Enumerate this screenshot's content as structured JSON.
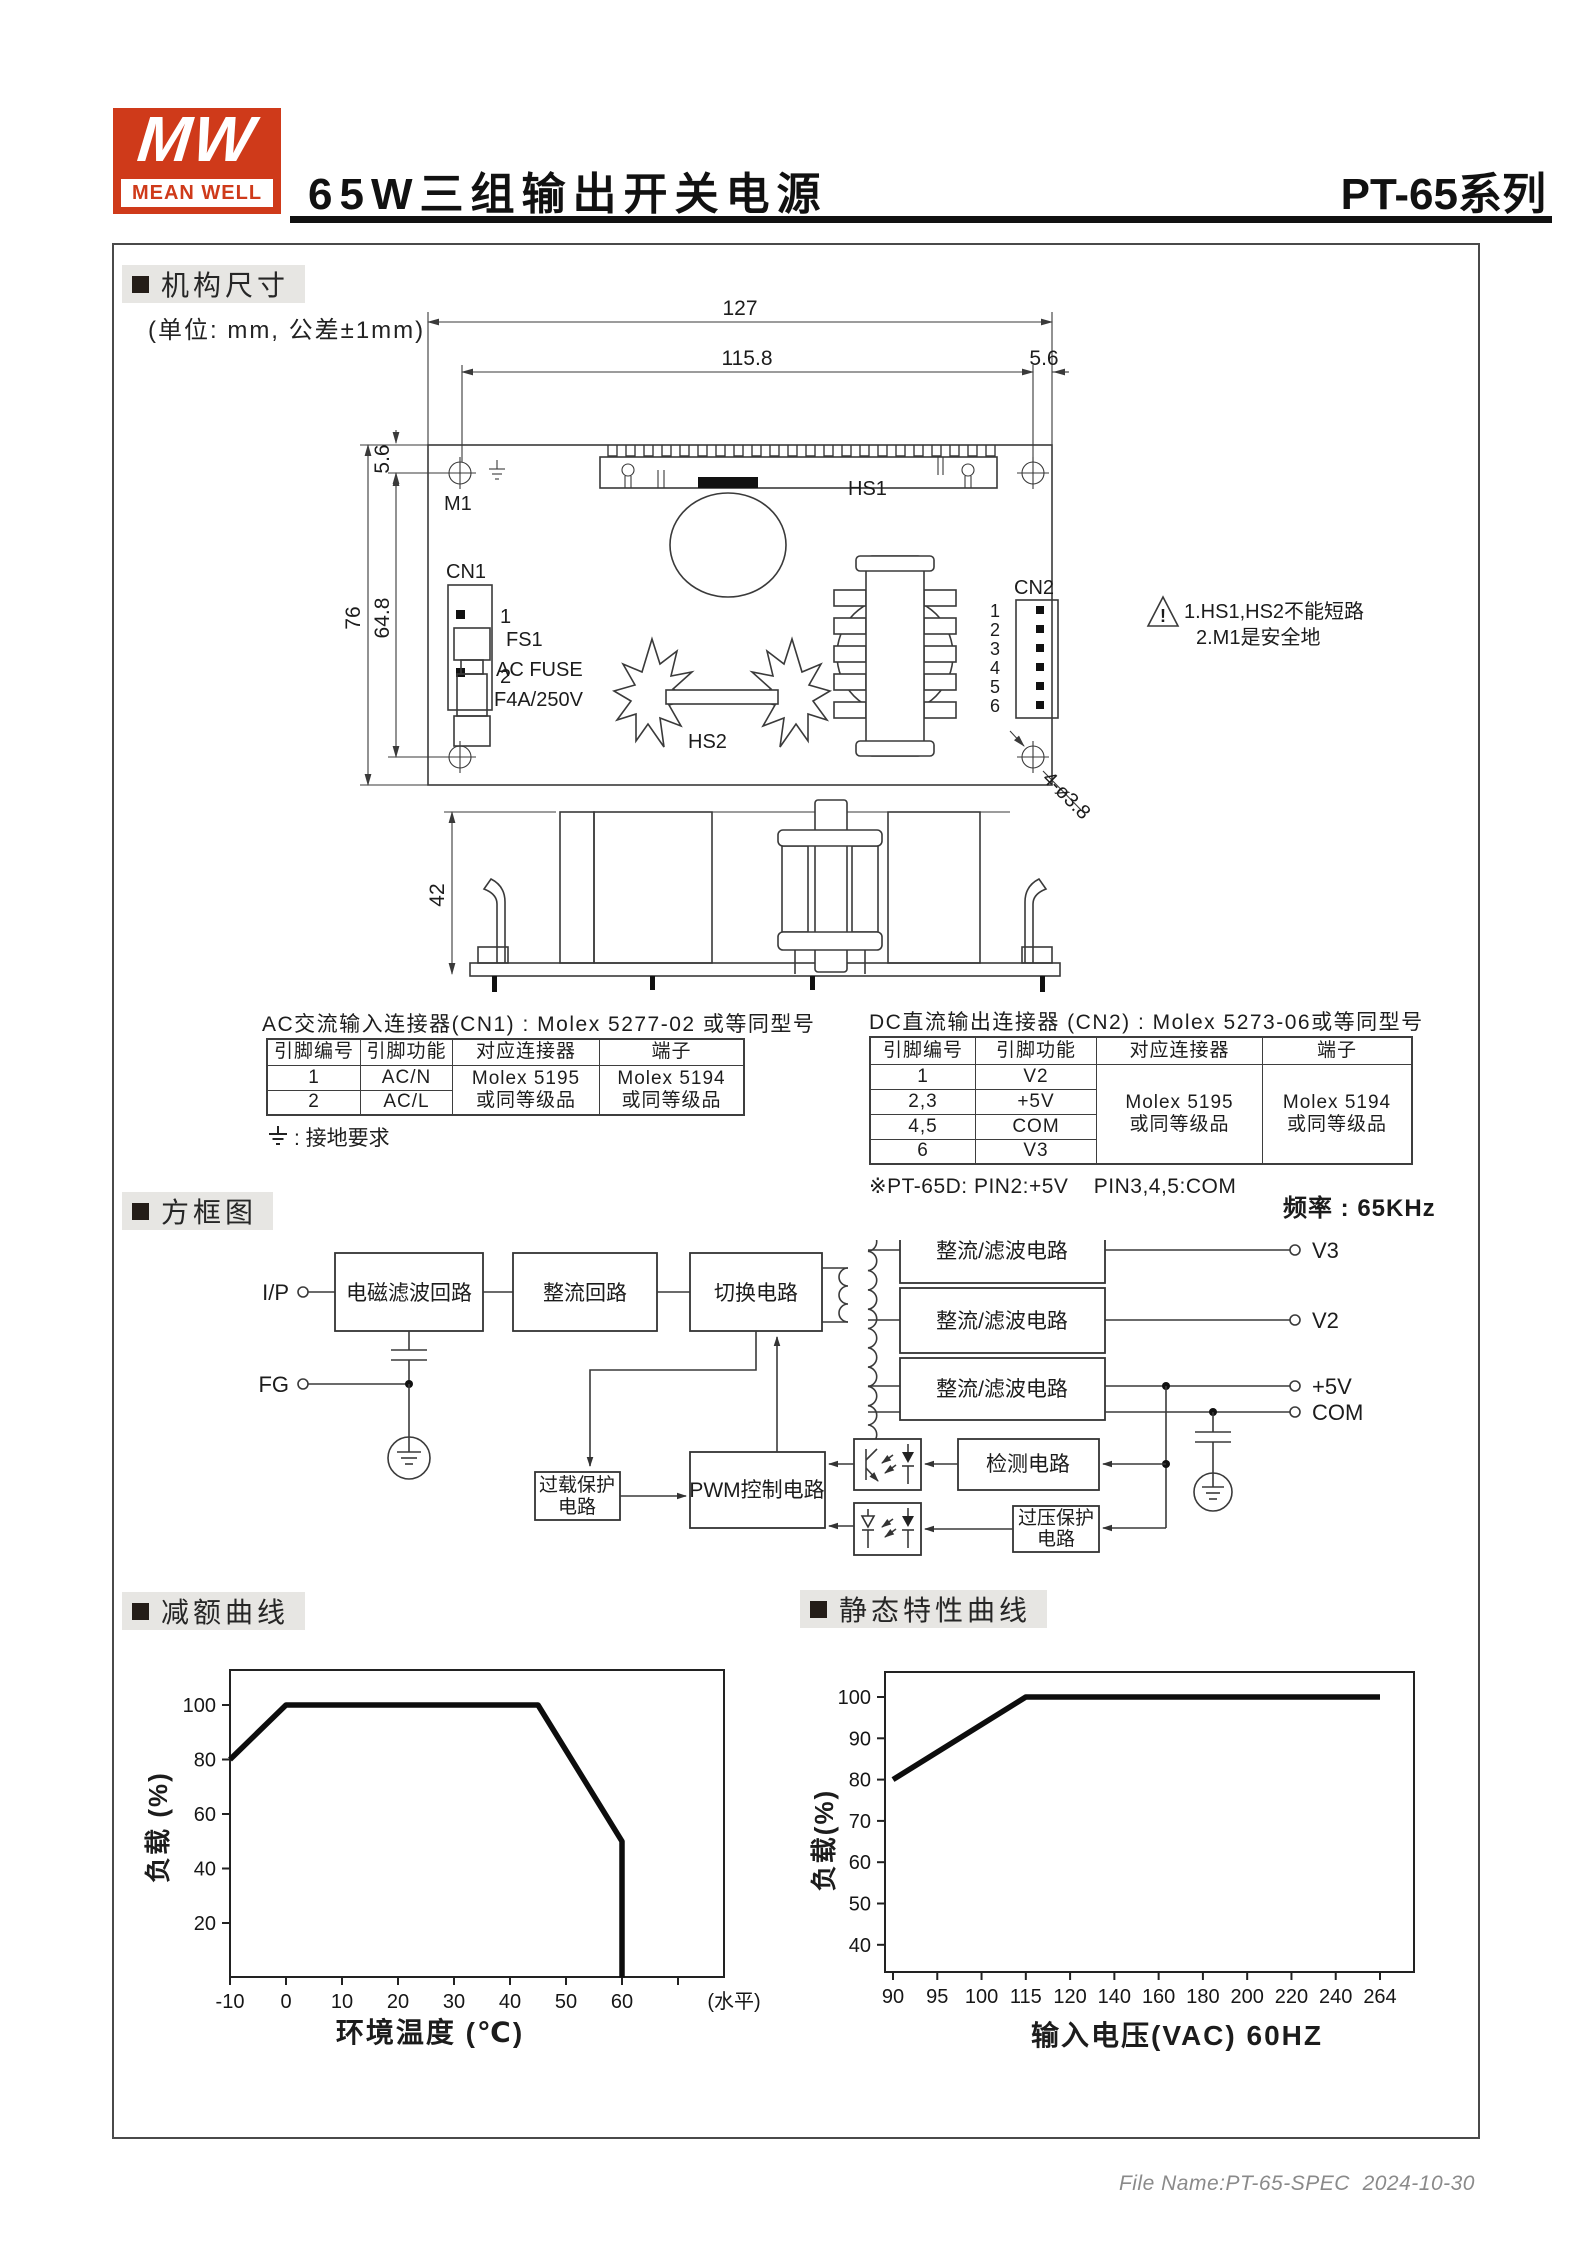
{
  "header": {
    "logo_mw": "MW",
    "logo_text": "MEAN WELL",
    "title": "65W三组输出开关电源",
    "series": "PT-65",
    "series_suffix": "系列"
  },
  "mechanical": {
    "section_title": "机构尺寸",
    "unit_note": "(单位: mm, 公差±1mm)",
    "dims": {
      "width_total": "127",
      "width_inner": "115.8",
      "right_offset": "5.6",
      "top_offset": "5.6",
      "height_inner": "64.8",
      "height_total": "76",
      "side_height": "42",
      "holes": "4-ø3.8"
    },
    "labels": {
      "m1": "M1",
      "cn1": "CN1",
      "cn1_pin1": "1",
      "cn1_pin2": "2",
      "fs1": "FS1",
      "fuse_line1": "AC FUSE",
      "fuse_line2": "F4A/250V",
      "hs1": "HS1",
      "hs2": "HS2",
      "cn2": "CN2"
    },
    "cn2_pins": [
      "1",
      "2",
      "3",
      "4",
      "5",
      "6"
    ],
    "warning_line1": "1.HS1,HS2不能短路",
    "warning_line2": "2.M1是安全地",
    "warning_mark": "!"
  },
  "cn1_table": {
    "title": "AC交流输入连接器(CN1) : Molex 5277-02 或等同型号",
    "headers": [
      "引脚编号",
      "引脚功能",
      "对应连接器",
      "端子"
    ],
    "rows": [
      [
        "1",
        "AC/N"
      ],
      [
        "2",
        "AC/L"
      ]
    ],
    "connector_cell": [
      "Molex 5195",
      "或同等级品"
    ],
    "terminal_cell": [
      "Molex 5194",
      "或同等级品"
    ],
    "ground_note": ": 接地要求"
  },
  "cn2_table": {
    "title": "DC直流输出连接器 (CN2) : Molex 5273-06或等同型号",
    "headers": [
      "引脚编号",
      "引脚功能",
      "对应连接器",
      "端子"
    ],
    "rows": [
      [
        "1",
        "V2"
      ],
      [
        "2,3",
        "+5V"
      ],
      [
        "4,5",
        "COM"
      ],
      [
        "6",
        "V3"
      ]
    ],
    "connector_cell": [
      "Molex 5195",
      "或同等级品"
    ],
    "terminal_cell": [
      "Molex 5194",
      "或同等级品"
    ],
    "note": "※PT-65D: PIN2:+5V    PIN3,4,5:COM"
  },
  "block_diagram": {
    "section_title": "方框图",
    "frequency_note": "频率 : 65KHz",
    "terminals": {
      "input": "I/P",
      "fg": "FG",
      "v3": "V3",
      "v2": "V2",
      "v5": "+5V",
      "com": "COM"
    },
    "boxes": {
      "emi": "电磁滤波回路",
      "rectifier": "整流回路",
      "switching": "切换电路",
      "pwm": "PWM控制电路",
      "overload_1": "过载保护",
      "overload_2": "电路",
      "detection": "检测电路",
      "ovp_1": "过压保护",
      "ovp_2": "电路",
      "rect_filter": "整流/滤波电路"
    }
  },
  "chart_data": [
    {
      "type": "line",
      "title": "减额曲线",
      "xlabel": "环境温度 (℃)",
      "ylabel": "负载 (%)",
      "x_unit_suffix": "(水平)",
      "x_ticks": [
        -10,
        0,
        10,
        20,
        30,
        40,
        50,
        60
      ],
      "y_ticks": [
        20,
        40,
        60,
        80,
        100
      ],
      "points": [
        [
          -10,
          80
        ],
        [
          0,
          100
        ],
        [
          45,
          100
        ],
        [
          60,
          50
        ],
        [
          60,
          0
        ]
      ],
      "xlim": [
        -10,
        78
      ],
      "ylim": [
        0,
        112
      ],
      "grid": false,
      "legend": "none"
    },
    {
      "type": "line",
      "title": "静态特性曲线",
      "xlabel": "输入电压(VAC) 60HZ",
      "ylabel": "负载(%)",
      "x_tick_labels": [
        "90",
        "95",
        "100",
        "115",
        "120",
        "140",
        "160",
        "180",
        "200",
        "220",
        "240",
        "264"
      ],
      "y_ticks": [
        40,
        50,
        60,
        70,
        80,
        90,
        100
      ],
      "points_by_label": [
        [
          "90",
          80
        ],
        [
          "115",
          100
        ],
        [
          "264",
          100
        ]
      ],
      "ylim": [
        33,
        106
      ],
      "grid": false,
      "legend": "none"
    }
  ],
  "footer": {
    "text": "File Name:PT-65-SPEC  2024-10-30"
  }
}
